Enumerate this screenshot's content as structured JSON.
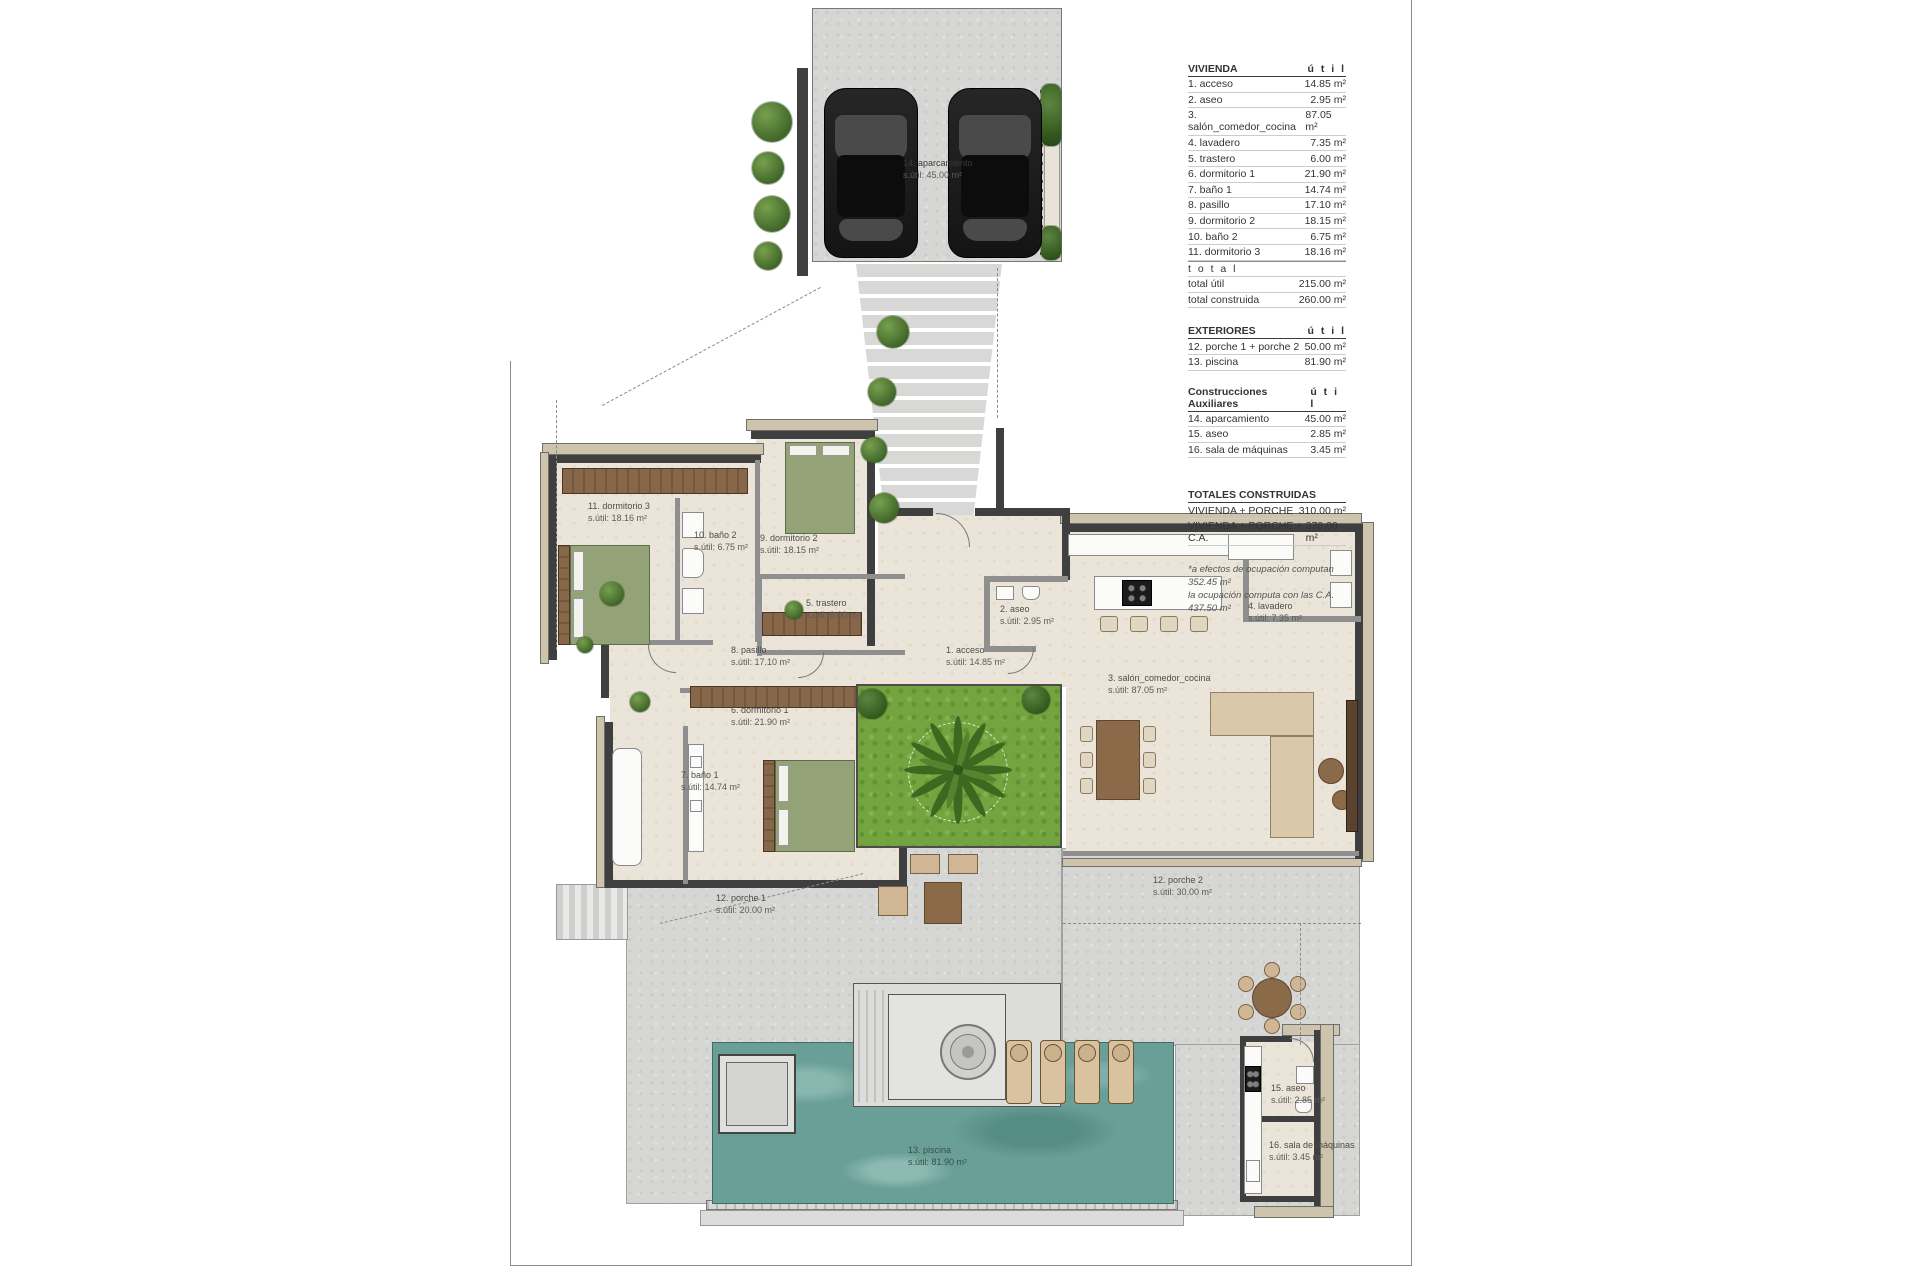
{
  "legend": {
    "vivienda": {
      "title": "VIVIENDA",
      "util_header": "ú t i l",
      "rows": [
        {
          "label": "1. acceso",
          "value": "14.85 m²"
        },
        {
          "label": "2. aseo",
          "value": "2.95 m²"
        },
        {
          "label": "3. salón_comedor_cocina",
          "value": "87.05 m²"
        },
        {
          "label": "4. lavadero",
          "value": "7.35 m²"
        },
        {
          "label": "5. trastero",
          "value": "6.00 m²"
        },
        {
          "label": "6. dormitorio 1",
          "value": "21.90 m²"
        },
        {
          "label": "7. baño 1",
          "value": "14.74 m²"
        },
        {
          "label": "8. pasillo",
          "value": "17.10 m²"
        },
        {
          "label": "9. dormitorio 2",
          "value": "18.15 m²"
        },
        {
          "label": "10. baño 2",
          "value": "6.75 m²"
        },
        {
          "label": "11. dormitorio 3",
          "value": "18.16 m²"
        }
      ],
      "total_label": "t o t a l",
      "totals": [
        {
          "label": "total útil",
          "value": "215.00 m²"
        },
        {
          "label": "total construida",
          "value": "260.00 m²"
        }
      ]
    },
    "exteriores": {
      "title": "EXTERIORES",
      "util_header": "ú t i l",
      "rows": [
        {
          "label": "12. porche 1 + porche 2",
          "value": "50.00 m²"
        },
        {
          "label": "13. piscina",
          "value": "81.90 m²"
        }
      ]
    },
    "auxiliares": {
      "title": "Construcciones Auxiliares",
      "util_header": "ú t i l",
      "rows": [
        {
          "label": "14. aparcamiento",
          "value": "45.00 m²"
        },
        {
          "label": "15. aseo",
          "value": "2.85 m²"
        },
        {
          "label": "16. sala de máquinas",
          "value": "3.45 m²"
        }
      ]
    },
    "totales": {
      "title": "TOTALES CONSTRUIDAS",
      "rows": [
        {
          "label": "VIVIENDA + PORCHE",
          "value": "310.00 m²"
        },
        {
          "label": "VIVIENDA + PORCHE + C.A.",
          "value": "370.00 m²"
        }
      ],
      "footnote_line1": "*a efectos de ocupación computan 352.45 m²",
      "footnote_line2": "la ocupación computa con las C.A. 437.50 m²"
    }
  },
  "plan": {
    "labels": [
      {
        "name": "14. aparcamiento",
        "area": "s.útil: 45.00 m²"
      },
      {
        "name": "11. dormitorio 3",
        "area": "s.útil: 18.16 m²"
      },
      {
        "name": "10. baño 2",
        "area": "s.útil: 6.75 m²"
      },
      {
        "name": "9. dormitorio 2",
        "area": "s.útil: 18.15 m²"
      },
      {
        "name": "5. trastero",
        "area": "s.útil: 6.00 m²"
      },
      {
        "name": "2. aseo",
        "area": "s.útil: 2.95 m²"
      },
      {
        "name": "1. acceso",
        "area": "s.útil: 14.85 m²"
      },
      {
        "name": "4. lavadero",
        "area": "s.útil: 7.35 m²"
      },
      {
        "name": "3. salón_comedor_cocina",
        "area": "s.útil: 87.05 m²"
      },
      {
        "name": "8. pasillo",
        "area": "s.útil: 17.10 m²"
      },
      {
        "name": "6. dormitorio 1",
        "area": "s.útil: 21.90 m²"
      },
      {
        "name": "7. baño 1",
        "area": "s.útil: 14.74 m²"
      },
      {
        "name": "12. porche 1",
        "area": "s.útil: 20.00 m²"
      },
      {
        "name": "12. porche 2",
        "area": "s.útil: 30.00 m²"
      },
      {
        "name": "13. piscina",
        "area": "s.útil: 81.90 m²"
      },
      {
        "name": "15. aseo",
        "area": "s.útil: 2.85 m²"
      },
      {
        "name": "16. sala de máquinas",
        "area": "s.útil: 3.45 m²"
      }
    ]
  },
  "colors": {
    "concrete": "#d6d6d4",
    "interior_floor": "#ebe5d9",
    "wall_dark": "#3f3f3f",
    "outer_band_tan": "#cec3ab",
    "grass_green": "#74a440",
    "pool_water": "#6a9f97",
    "wood_brown": "#86674a",
    "furniture_tan": "#cfb795",
    "text": "#3c3c3c"
  }
}
